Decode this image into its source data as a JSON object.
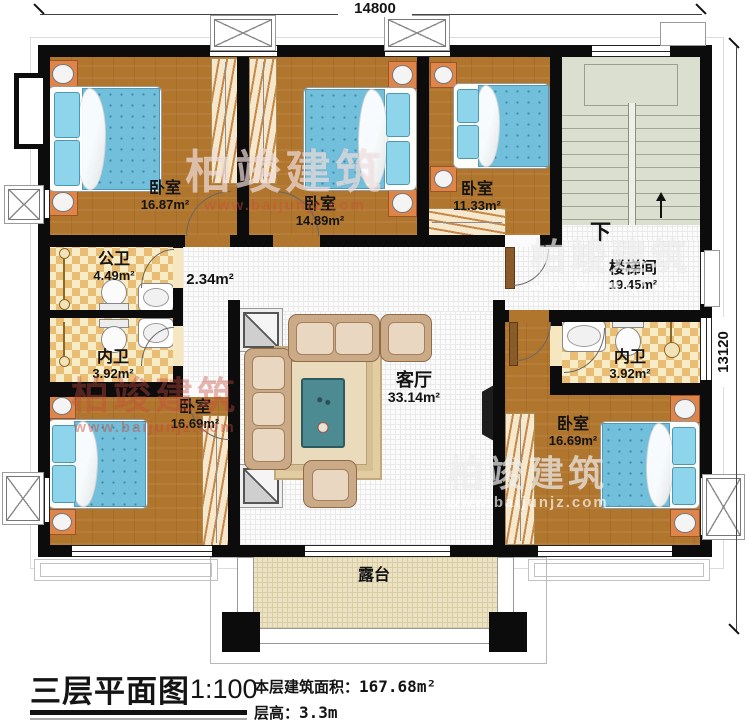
{
  "dimensions": {
    "top": "14800",
    "right": "13120"
  },
  "rooms": [
    {
      "id": "bedroom-top-left",
      "name": "卧室",
      "area": "16.87m²"
    },
    {
      "id": "bedroom-top-middle",
      "name": "卧室",
      "area": "14.89m²"
    },
    {
      "id": "bedroom-top-right",
      "name": "卧室",
      "area": "11.33m²"
    },
    {
      "id": "stairwell",
      "name": "楼梯间",
      "area": "19.45m²"
    },
    {
      "id": "bath-public",
      "name": "公卫",
      "area": "4.49m²"
    },
    {
      "id": "bath-ensuite-left",
      "name": "内卫",
      "area": "3.92m²"
    },
    {
      "id": "corridor",
      "name": "",
      "area": "2.34m²"
    },
    {
      "id": "living-room",
      "name": "客厅",
      "area": "33.14m²"
    },
    {
      "id": "bath-ensuite-right",
      "name": "内卫",
      "area": "3.92m²"
    },
    {
      "id": "bedroom-bottom-left",
      "name": "卧室",
      "area": "16.69m²"
    },
    {
      "id": "bedroom-bottom-right",
      "name": "卧室",
      "area": "16.69m²"
    },
    {
      "id": "terrace",
      "name": "露台",
      "area": ""
    }
  ],
  "stairs": {
    "down": "下"
  },
  "title_block": {
    "title": "三层平面图",
    "scale": "1:100",
    "area_label": "本层建筑面积：",
    "area_value": "167.68m²",
    "floor_height_label": "层高：",
    "floor_height_value": "3.3m"
  },
  "watermark": {
    "brand": "柏竣建筑",
    "url": "www.baijunjz.com"
  },
  "colors": {
    "wall": "#0c0c0c",
    "wood": "#b1762e",
    "tile_dark": "#e9bd73",
    "stair": "#dbdfd0",
    "mattress": "#72bfdb",
    "terrace": "#ece2c4"
  }
}
